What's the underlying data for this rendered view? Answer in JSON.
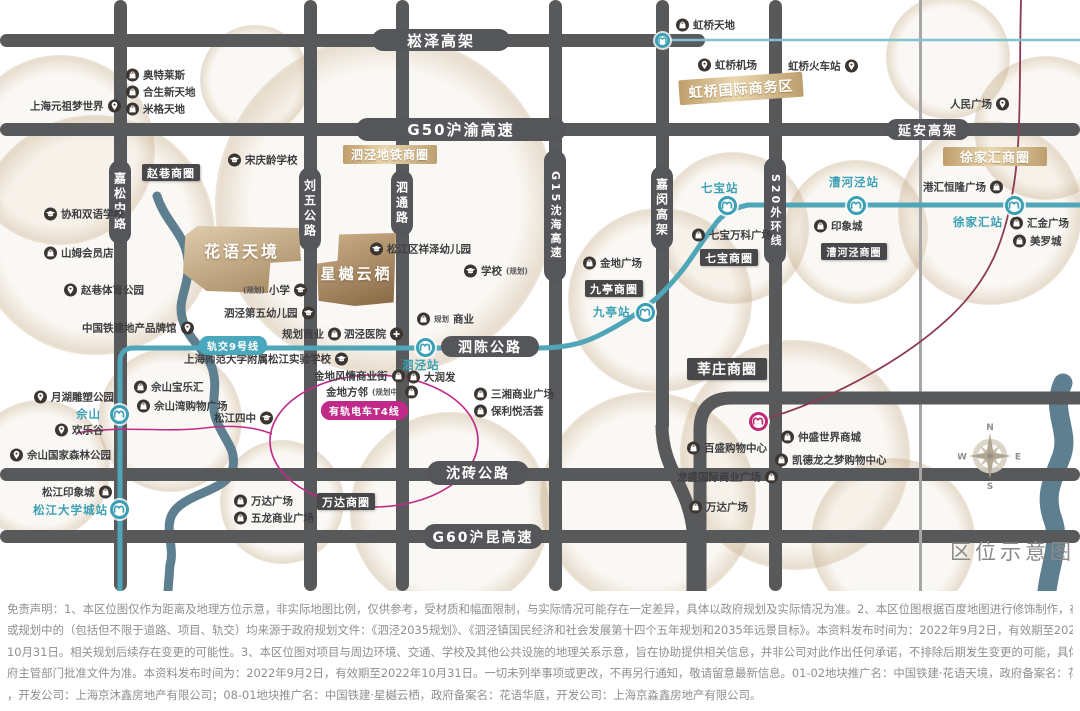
{
  "map": {
    "title": "区位示意图",
    "compass": {
      "n": "N",
      "e": "E",
      "s": "S",
      "w": "W"
    },
    "colors": {
      "road": "#58595B",
      "metro_teal": "#4FA6B8",
      "tram_magenta": "#C02B8A",
      "rail_maroon": "#8C3B55",
      "river": "#5E7F90",
      "gold": "#C9A877",
      "district_dark": "#48484A"
    },
    "road_bars": {
      "h": [
        {
          "y": 34,
          "x": 0,
          "w": 705
        },
        {
          "y": 123,
          "x": 0,
          "w": 1080
        },
        {
          "y": 468,
          "x": 0,
          "w": 1080
        },
        {
          "y": 530,
          "x": 0,
          "w": 1080
        }
      ],
      "v": [
        {
          "x": 114,
          "y": 0,
          "h": 591
        },
        {
          "x": 304,
          "y": 0,
          "h": 591
        },
        {
          "x": 396,
          "y": 0,
          "h": 591
        },
        {
          "x": 549,
          "y": 0,
          "h": 591
        },
        {
          "x": 656,
          "y": 0,
          "h": 432
        },
        {
          "x": 769,
          "y": 0,
          "h": 591
        }
      ],
      "thin": [
        {
          "x": 919,
          "y": 0,
          "h": 591
        }
      ]
    },
    "road_labels": {
      "h": [
        {
          "t": "崧泽高架",
          "x": 372,
          "y": 29,
          "w": 138,
          "h": 22,
          "fs": 15
        },
        {
          "t": "G50沪渝高速",
          "x": 356,
          "y": 118,
          "w": 210,
          "h": 23,
          "fs": 15
        },
        {
          "t": "延安高架",
          "x": 886,
          "y": 119,
          "w": 84,
          "h": 21,
          "fs": 13
        },
        {
          "t": "泗陈公路",
          "x": 441,
          "y": 336,
          "w": 98,
          "h": 21,
          "fs": 14
        },
        {
          "t": "沈砖公路",
          "x": 427,
          "y": 461,
          "w": 102,
          "h": 24,
          "fs": 14
        },
        {
          "t": "G60沪昆高速",
          "x": 423,
          "y": 524,
          "w": 120,
          "h": 25,
          "fs": 14
        }
      ],
      "v": [
        {
          "t": "嘉松中路",
          "x": 109,
          "y": 160,
          "w": 22,
          "h": 84,
          "fs": 12
        },
        {
          "t": "刘五公路",
          "x": 299,
          "y": 167,
          "w": 22,
          "h": 84,
          "fs": 12
        },
        {
          "t": "泗通路",
          "x": 391,
          "y": 170,
          "w": 22,
          "h": 66,
          "fs": 12
        },
        {
          "t": "G15沈海高速",
          "x": 544,
          "y": 150,
          "w": 22,
          "h": 132,
          "fs": 11
        },
        {
          "t": "嘉闵高架",
          "x": 651,
          "y": 166,
          "w": 22,
          "h": 84,
          "fs": 12
        },
        {
          "t": "S20外环线",
          "x": 764,
          "y": 157,
          "w": 22,
          "h": 108,
          "fs": 11
        }
      ]
    },
    "transit_labels": [
      {
        "t": "轨交9号线",
        "x": 199,
        "y": 336,
        "c": "teal"
      },
      {
        "t": "有轨电车T4线",
        "x": 321,
        "y": 401,
        "c": "magenta"
      }
    ],
    "districts": [
      {
        "t": "赵巷商圈",
        "x": 142,
        "y": 164,
        "w": 58,
        "h": 17,
        "style": "dark",
        "fs": 11
      },
      {
        "t": "九亭商圈",
        "x": 585,
        "y": 280,
        "w": 58,
        "h": 17,
        "style": "dark",
        "fs": 11
      },
      {
        "t": "七宝商圈",
        "x": 700,
        "y": 249,
        "w": 58,
        "h": 17,
        "style": "dark",
        "fs": 11
      },
      {
        "t": "漕河泾商圈",
        "x": 821,
        "y": 243,
        "w": 66,
        "h": 17,
        "style": "dark",
        "fs": 10
      },
      {
        "t": "莘庄商圈",
        "x": 687,
        "y": 358,
        "w": 80,
        "h": 22,
        "style": "dark",
        "fs": 14
      },
      {
        "t": "万达商圈",
        "x": 317,
        "y": 493,
        "w": 58,
        "h": 17,
        "style": "dark",
        "fs": 11
      },
      {
        "t": "泗泾地铁商圈",
        "x": 343,
        "y": 145,
        "w": 94,
        "h": 19,
        "style": "gold",
        "fs": 12
      },
      {
        "t": "虹桥国际商务区",
        "x": 679,
        "y": 76,
        "w": 124,
        "h": 25,
        "style": "gold",
        "fs": 14,
        "rot": -4
      },
      {
        "t": "徐家汇商圈",
        "x": 943,
        "y": 147,
        "w": 104,
        "h": 19,
        "style": "gold",
        "fs": 13
      }
    ],
    "projects": [
      {
        "t": "花语天境",
        "x": 183,
        "y": 226,
        "w": 118,
        "h": 67,
        "fs": 16,
        "g1": "#e0ccae",
        "g2": "#a4875f",
        "clip": "polygon(12% 0%, 98% 3%, 100% 52%, 74% 55%, 72% 100%, 20% 97%, 0% 70%, 2% 14%)",
        "pt": 12
      },
      {
        "t": "星樾云栖",
        "x": 317,
        "y": 233,
        "w": 79,
        "h": 73,
        "fs": 15,
        "g1": "#cdb08a",
        "g2": "#876845",
        "clip": "polygon(28% 2%, 100% 0%, 97% 95%, 48% 100%, 2% 93%, 0% 42%, 26% 38%)",
        "pt": 30
      }
    ],
    "stations": [
      {
        "t": "佘山",
        "cx": 119,
        "cy": 414,
        "lx": 76,
        "ly": 406,
        "c": "teal"
      },
      {
        "t": "松江大学城站",
        "cx": 119,
        "cy": 509,
        "lx": 33,
        "ly": 502,
        "c": "teal"
      },
      {
        "t": "泗泾站",
        "cx": 425,
        "cy": 347,
        "lx": 402,
        "ly": 357,
        "c": "teal"
      },
      {
        "t": "九亭站",
        "cx": 645,
        "cy": 312,
        "lx": 593,
        "ly": 304,
        "c": "teal"
      },
      {
        "t": "七宝站",
        "cx": 727,
        "cy": 205,
        "lx": 701,
        "ly": 180,
        "c": "teal"
      },
      {
        "t": "漕河泾站",
        "cx": 856,
        "cy": 205,
        "lx": 829,
        "ly": 174,
        "c": "teal"
      },
      {
        "t": "徐家汇站",
        "cx": 1014,
        "cy": 205,
        "lx": 953,
        "ly": 214,
        "c": "teal"
      },
      {
        "t": "",
        "cx": 758,
        "cy": 421,
        "c": "magenta"
      },
      {
        "t": "",
        "cx": 662,
        "cy": 40,
        "c": "teal",
        "small": true
      }
    ],
    "pois": [
      {
        "t": "奥特莱斯",
        "i": "mall",
        "x": 126,
        "y": 75
      },
      {
        "t": "合生新天地",
        "i": "mall",
        "x": 126,
        "y": 92
      },
      {
        "t": "米格天地",
        "i": "mall",
        "x": 126,
        "y": 109
      },
      {
        "t": "上海元祖梦世界",
        "i": "pin",
        "x": 30,
        "y": 106,
        "side": "r"
      },
      {
        "t": "宋庆龄学校",
        "i": "school",
        "x": 228,
        "y": 160
      },
      {
        "t": "协和双语学校",
        "i": "school",
        "x": 44,
        "y": 214
      },
      {
        "t": "山姆会员店",
        "i": "mall",
        "x": 44,
        "y": 253
      },
      {
        "t": "赵巷体育公园",
        "i": "pin",
        "x": 64,
        "y": 290
      },
      {
        "t": "中国铁建地产品牌馆",
        "i": "pin",
        "x": 82,
        "y": 328,
        "side": "r"
      },
      {
        "t": "虹桥天地",
        "i": "mall",
        "x": 676,
        "y": 25
      },
      {
        "t": "虹桥机场",
        "i": "pin",
        "x": 698,
        "y": 65
      },
      {
        "t": "虹桥火车站",
        "i": "pin",
        "x": 788,
        "y": 66,
        "side": "r"
      },
      {
        "t": "人民广场",
        "i": "pin",
        "x": 950,
        "y": 104,
        "side": "r"
      },
      {
        "t": "金地广场",
        "i": "mall",
        "x": 583,
        "y": 263
      },
      {
        "t": "学校",
        "i": "school",
        "x": 464,
        "y": 271,
        "s": "(规划)",
        "sp": "post"
      },
      {
        "t": "松江区祥泽幼儿园",
        "i": "school",
        "x": 370,
        "y": 249
      },
      {
        "t": "小学",
        "i": "school",
        "x": 243,
        "y": 290,
        "side": "r",
        "s": "(规划)",
        "sp": "pre"
      },
      {
        "t": "泗泾第五幼儿园",
        "i": "school",
        "x": 224,
        "y": 313,
        "side": "r"
      },
      {
        "t": "规划商业",
        "i": "mall",
        "x": 282,
        "y": 334,
        "side": "r"
      },
      {
        "t": "泗泾医院",
        "i": "hosp",
        "x": 344,
        "y": 334,
        "side": "r"
      },
      {
        "t": "商业",
        "i": "mall",
        "x": 417,
        "y": 319,
        "s": "规划",
        "sp": "pre"
      },
      {
        "t": "大润发",
        "i": "mall",
        "x": 407,
        "y": 377
      },
      {
        "t": "三湘商业广场",
        "i": "mall",
        "x": 474,
        "y": 394
      },
      {
        "t": "保利悦活荟",
        "i": "mall",
        "x": 474,
        "y": 411
      },
      {
        "t": "金地风情商业街",
        "i": "mall",
        "x": 314,
        "y": 376,
        "side": "r"
      },
      {
        "t": "金地方邻",
        "i": "mall",
        "x": 326,
        "y": 392,
        "side": "r",
        "s": "(规划中)",
        "sp": "post"
      },
      {
        "t": "上海师范大学附属松江实验学校",
        "i": "school",
        "x": 184,
        "y": 359,
        "side": "r"
      },
      {
        "t": "松江四中",
        "i": "school",
        "x": 214,
        "y": 418,
        "side": "r"
      },
      {
        "t": "佘山宝乐汇",
        "i": "mall",
        "x": 134,
        "y": 387
      },
      {
        "t": "佘山湾购物广场",
        "i": "mall",
        "x": 137,
        "y": 406
      },
      {
        "t": "月湖雕塑公园",
        "i": "pin",
        "x": 34,
        "y": 397
      },
      {
        "t": "欢乐谷",
        "i": "pin",
        "x": 55,
        "y": 430
      },
      {
        "t": "佘山国家森林公园",
        "i": "pin",
        "x": 10,
        "y": 455
      },
      {
        "t": "松江印象城",
        "i": "mall",
        "x": 42,
        "y": 492,
        "side": "r"
      },
      {
        "t": "万达广场",
        "i": "mall",
        "x": 234,
        "y": 501
      },
      {
        "t": "五龙商业广场",
        "i": "mall",
        "x": 234,
        "y": 518
      },
      {
        "t": "七宝万科广场",
        "i": "mall",
        "x": 692,
        "y": 235
      },
      {
        "t": "印象城",
        "i": "mall",
        "x": 814,
        "y": 226
      },
      {
        "t": "港汇恒隆广场",
        "i": "mall",
        "x": 923,
        "y": 187,
        "side": "r"
      },
      {
        "t": "汇金广场",
        "i": "mall",
        "x": 1010,
        "y": 223
      },
      {
        "t": "美罗城",
        "i": "mall",
        "x": 1013,
        "y": 241
      },
      {
        "t": "仲盛世界商城",
        "i": "mall",
        "x": 781,
        "y": 437
      },
      {
        "t": "百盛购物中心",
        "i": "mall",
        "x": 687,
        "y": 448
      },
      {
        "t": "凯德龙之梦购物中心",
        "i": "mall",
        "x": 775,
        "y": 460
      },
      {
        "t": "龙盛国际商业广场",
        "i": "mall",
        "x": 677,
        "y": 477,
        "side": "r"
      },
      {
        "t": "万达广场",
        "i": "mall",
        "x": 689,
        "y": 507
      }
    ],
    "blobs": [
      {
        "x": 60,
        "y": 150,
        "r": 95
      },
      {
        "x": 95,
        "y": 235,
        "r": 120
      },
      {
        "x": 385,
        "y": 205,
        "r": 170
      },
      {
        "x": 255,
        "y": 80,
        "r": 55
      },
      {
        "x": 660,
        "y": 300,
        "r": 92
      },
      {
        "x": 733,
        "y": 228,
        "r": 76
      },
      {
        "x": 856,
        "y": 232,
        "r": 72
      },
      {
        "x": 990,
        "y": 213,
        "r": 92
      },
      {
        "x": 795,
        "y": 455,
        "r": 115
      },
      {
        "x": 948,
        "y": 57,
        "r": 62
      },
      {
        "x": 1046,
        "y": 128,
        "r": 72
      },
      {
        "x": 170,
        "y": 420,
        "r": 72
      },
      {
        "x": 282,
        "y": 502,
        "r": 62
      },
      {
        "x": 450,
        "y": 512,
        "r": 100
      },
      {
        "x": 648,
        "y": 500,
        "r": 108
      },
      {
        "x": 893,
        "y": 540,
        "r": 82
      },
      {
        "x": 40,
        "y": 470,
        "r": 70
      }
    ]
  },
  "disclaimer": {
    "lines": [
      "免责声明：1、本区位图仅作为距离及地理方位示意，非实际地图比例，仅供参考，受材质和幅面限制，与实际情况可能存在一定差异，具体以政府规划及实际情况为准。2、本区位图根据百度地图进行修饰制作，在建设中",
      "或规划中的（包括但不限于道路、项目、轨交）均来源于政府规划文件：《泗泾2035规划》、《泗泾镇国民经济和社会发展第十四个五年规划和2035年远景目标》。本资料发布时间为：2022年9月2日，有效期至2022年",
      "10月31日。相关规划后续存在变更的可能性。3、本区位图对项目与周边环境、交通、学校及其他公共设施的地理关系示意，旨在协助提供相关信息，并非公司对此作出任何承诺，不排除后期发生变更的可能，具体请以政",
      "府主管部门批准文件为准。本资料发布时间为：2022年9月2日，有效期至2022年10月31日。一切未列举事项或更改，不再另行通知，敬请留意最新信息。01-02地块推广名：中国铁建·花语天境，政府备案名：花语云庐",
      "，开发公司：上海京沐鑫房地产有限公司；08-01地块推广名：中国铁建·星樾云栖，政府备案名：花语华庭，开发公司：上海京淼鑫房地产有限公司。"
    ]
  }
}
